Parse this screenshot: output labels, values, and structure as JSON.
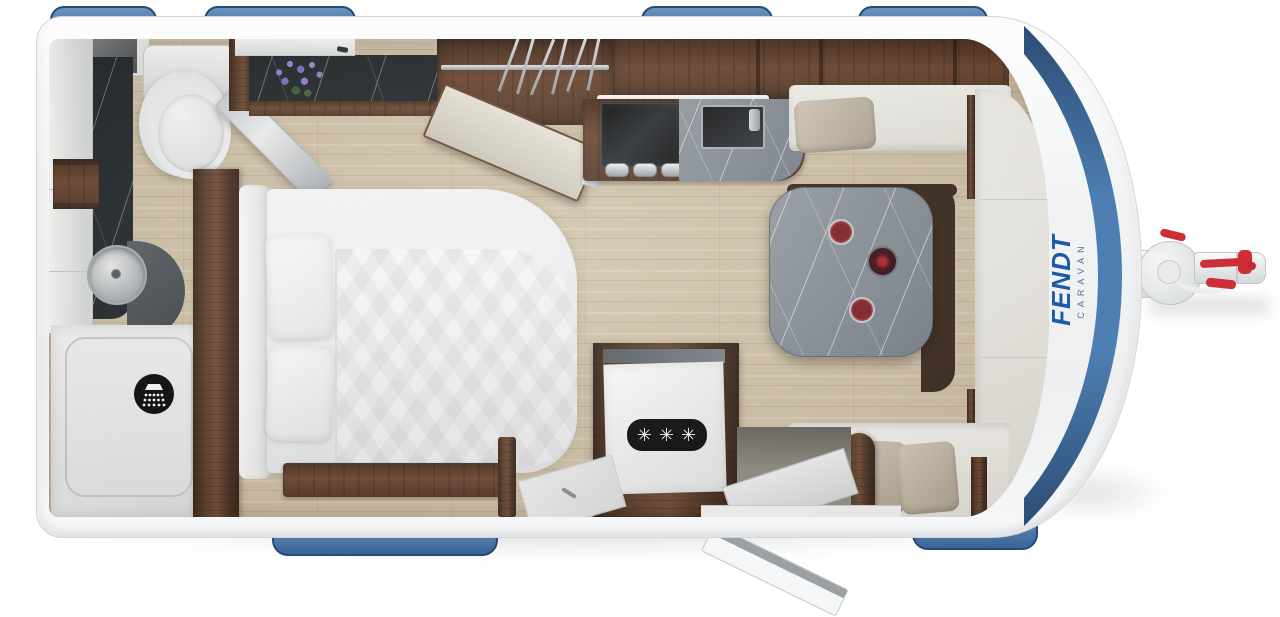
{
  "page": {
    "background": "#ffffff",
    "subject": "caravan floor plan render"
  },
  "branding": {
    "brand": "FENDT",
    "sub_brand": "CARAVAN",
    "brand_color": "#1b5aa6",
    "sub_color": "#4e6f9c"
  },
  "appliances": {
    "freezer_badge_stars": "✳✳✳"
  },
  "icons": {
    "shower": "shower-icon",
    "freezer": "freezer-stars-badge"
  },
  "palette": {
    "window_blue": "#4d7fb2",
    "window_blue_dark": "#274a70",
    "shell_white": "#f3f4f5",
    "wood_walnut": "#5e3f2e",
    "floor_oak": "#d2c4ab",
    "marble_dark": "#23282d",
    "marble_gray": "#848d95",
    "seat_cream": "#f3f2ee",
    "cushion_beige": "#c5bbaa",
    "wine_red": "#7e1e28",
    "hitch_red": "#ce2f37",
    "icon_black": "#0a0a0a"
  }
}
